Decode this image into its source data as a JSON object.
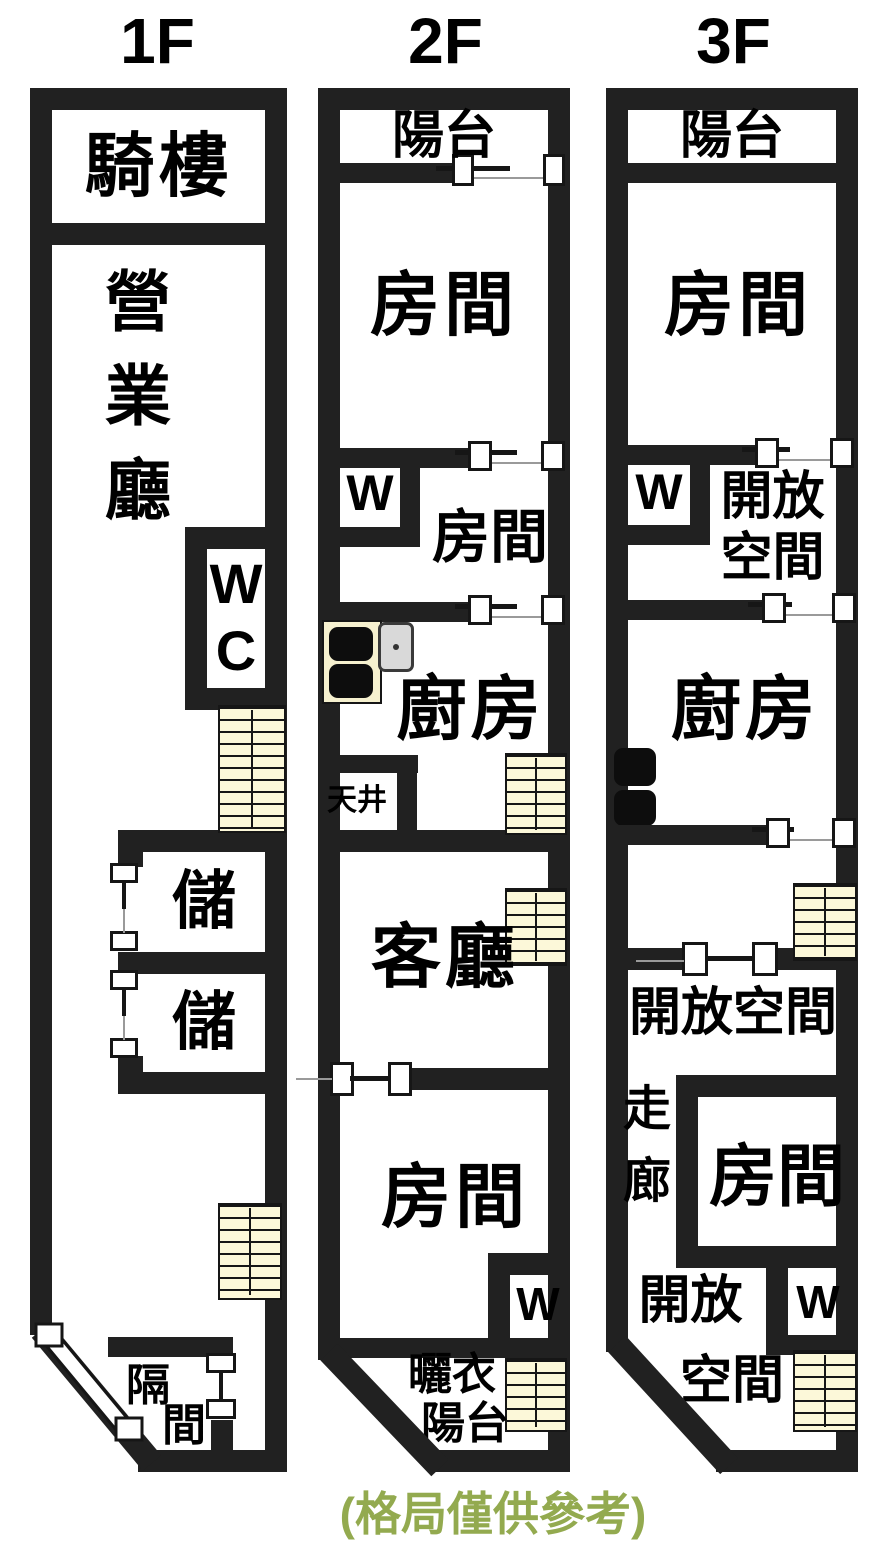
{
  "caption": "(格局僅供參考)",
  "floor1": {
    "title": "1F",
    "arcade": "騎樓",
    "business_hall": "營\n業\n廳",
    "wc": "W\nC",
    "storage_upper": "儲",
    "storage_lower": "儲",
    "partition_char1": "隔",
    "partition_char2": "間"
  },
  "floor2": {
    "title": "2F",
    "balcony": "陽台",
    "room_front": "房間",
    "closet_front": "W",
    "room_middle": "房間",
    "kitchen": "廚房",
    "light_well": "天井",
    "living_room": "客廳",
    "room_rear": "房間",
    "closet_rear": "W",
    "laundry_line1": "曬衣",
    "laundry_line2": "陽台"
  },
  "floor3": {
    "title": "3F",
    "balcony": "陽台",
    "room_front": "房間",
    "closet_front": "W",
    "open_space_front": "開放\n空間",
    "kitchen": "廚房",
    "open_space_middle": "開放空間",
    "corridor": "走\n廊",
    "room_rear": "房間",
    "open_space_rear_line1": "開放",
    "open_space_rear_line2": "空間",
    "closet_rear": "W"
  },
  "colors": {
    "wall": "#212121",
    "stairs_fill": "#fcf8d9",
    "caption_green": "#93aa4f"
  }
}
